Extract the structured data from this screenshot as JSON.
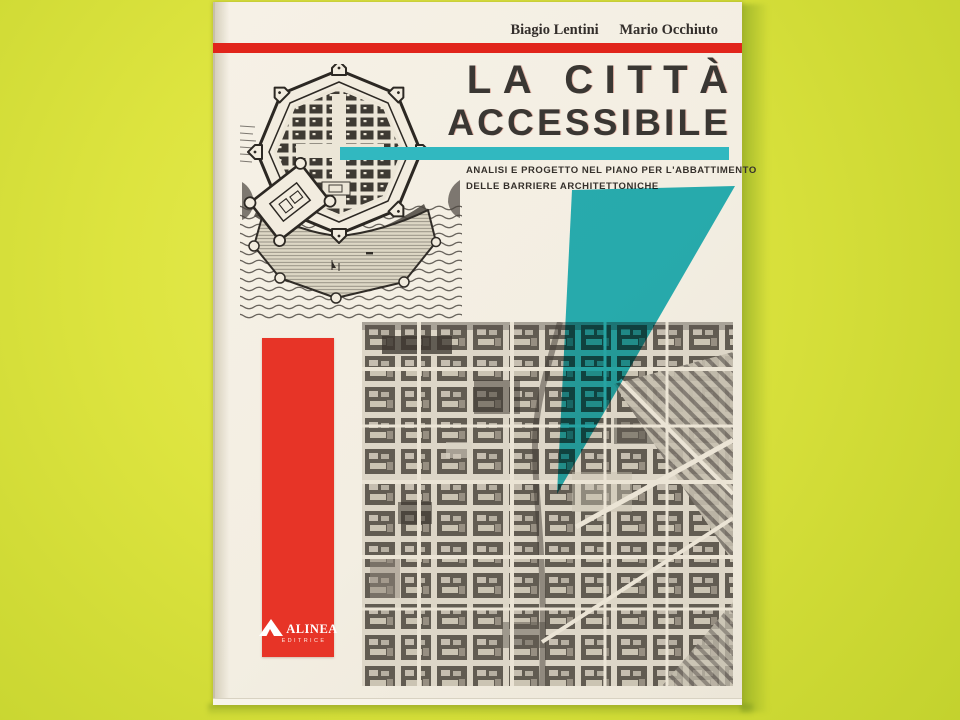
{
  "scene": {
    "description": "Photograph of a paperback book lying on a bright yellow-green surface"
  },
  "colors": {
    "bg-center": "#e7ec55",
    "bg-mid": "#dde43f",
    "bg-edge": "#cfda35",
    "cover": "#f3eee2",
    "cover-edge": "#d6cfbc",
    "red": "#e1251b",
    "red-box": "#e73427",
    "teal": "#31b8c0",
    "teal-wedge": "#29b6c2",
    "ink": "#35302b",
    "title-ink": "#3a3733"
  },
  "cover": {
    "authors": [
      "Biagio Lentini",
      "Mario Occhiuto"
    ],
    "title": {
      "line1": "LA CITTÀ",
      "line2": "ACCESSIBILE"
    },
    "subtitle": {
      "line1": "ANALISI E PROGETTO NEL PIANO PER L'ABBATTIMENTO",
      "line2": "DELLE BARRIERE ARCHITETTONICHE"
    },
    "publisher": {
      "name": "ALINEA",
      "tagline": "EDITRICE"
    },
    "artwork": {
      "engraving": "Antique engraving of an octagonal fortified city plan with a harbor and sea below",
      "aerial_map": "High-contrast black and white aerial view of a gridded city with diagonal rail yards",
      "teal_wedge": "Long teal wedge pointing down into the aerial map"
    }
  }
}
